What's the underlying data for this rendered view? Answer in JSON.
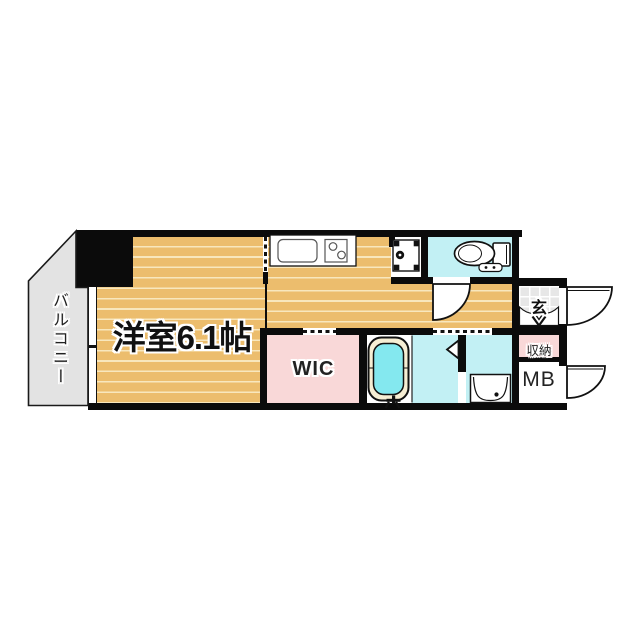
{
  "floorplan": {
    "type": "japanese-apartment-floor-plan",
    "rooms": {
      "main_room": {
        "label": "洋室6.1帖"
      },
      "balcony": {
        "label": "バルコニー"
      },
      "walk_in_closet": {
        "label": "WIC"
      },
      "entrance": {
        "label": "玄"
      },
      "storage": {
        "label": "収納"
      },
      "meter_box": {
        "label": "MB"
      }
    },
    "fixtures": {
      "kitchen_sink": "sink",
      "stove": "two-burner-stove",
      "washer_pan": "washing-machine-space",
      "toilet": "toilet",
      "bathtub": "bathtub",
      "washbasin": "washbasin",
      "entrance_door": "entrance-swing-door",
      "meter_box_door": "meter-box-swing-door",
      "toilet_door": "toilet-swing-door",
      "bath_folding_door": "bath-folding-door",
      "balcony_window": "sliding-window"
    },
    "colors": {
      "wall": "#0b0b0b",
      "flooring": "#ecbd6d",
      "flooring_stripe": "#f8e7bd",
      "wet_area_cyan": "#c2f0f4",
      "tub_water": "#84e8ef",
      "tub_rim": "#f6eed4",
      "closet_pink": "#f9d8d8",
      "balcony_gray": "#e3e3e3",
      "tile_gray": "#e7e7e7"
    }
  }
}
